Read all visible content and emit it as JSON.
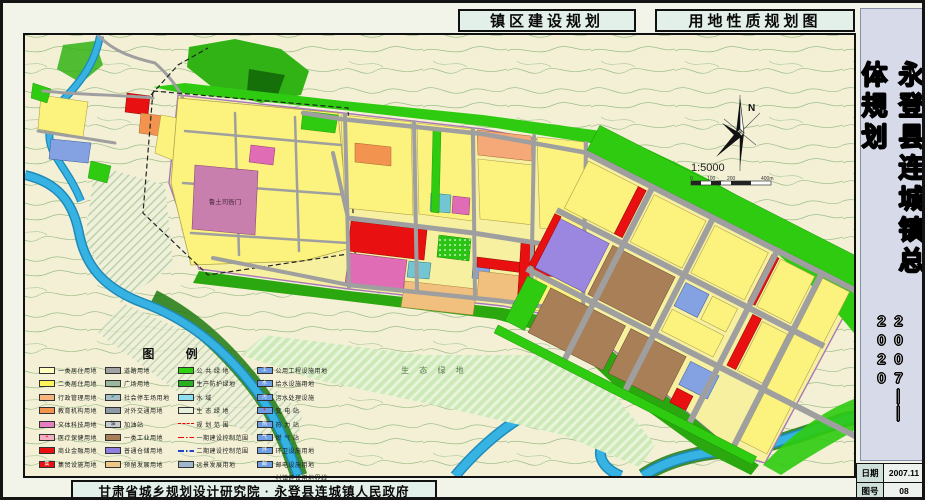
{
  "titles": {
    "left": "镇区建设规划",
    "right": "用地性质规划图"
  },
  "sidebar": {
    "title": "永登县连城镇总体规划",
    "years_top": "2007",
    "years_sep": "——",
    "years_bottom": "2020"
  },
  "info": {
    "rows": [
      {
        "label": "日期",
        "value": "2007.11"
      },
      {
        "label": "图号",
        "value": "08"
      }
    ]
  },
  "footer": {
    "attribution": "甘肃省城乡规划设计研究院 · 永登县连城镇人民政府"
  },
  "map": {
    "labels": {
      "luTusi": "鲁土司衙门",
      "eco": "生 态 绿 地"
    },
    "north": "N",
    "scale": {
      "text": "1:5000",
      "ticks": [
        "0",
        "100",
        "200",
        "400m"
      ]
    }
  },
  "legend": {
    "title": "图 例",
    "columns": [
      [
        {
          "label": "一类居住用地",
          "type": "fill",
          "color": "#ffffc2"
        },
        {
          "label": "二类居住用地",
          "type": "fill",
          "color": "#fdf35a"
        },
        {
          "label": "行政管理用地",
          "type": "fill",
          "color": "#f8b47e"
        },
        {
          "label": "教育机构用地",
          "type": "fill",
          "color": "#f2944e"
        },
        {
          "label": "文体科技用地",
          "type": "fill",
          "color": "#e67ec2"
        },
        {
          "label": "医疗保健用地",
          "type": "fill",
          "color": "#f4aec4",
          "glyph": "+",
          "glyphColor": "#d00"
        },
        {
          "label": "商业金融用地",
          "type": "fill",
          "color": "#e81010"
        },
        {
          "label": "集贸设施用地",
          "type": "fill",
          "color": "#e81010",
          "glyph": "集",
          "glyphColor": "#fff"
        }
      ],
      [
        {
          "label": "道路用地",
          "type": "fill",
          "color": "#a2a2a2"
        },
        {
          "label": "广场用地",
          "type": "fill",
          "color": "#9cb89c"
        },
        {
          "label": "社会停车场用地",
          "type": "fill",
          "color": "#a8bcc6",
          "glyph": "P",
          "glyphColor": "#066"
        },
        {
          "label": "对外交通用地",
          "type": "fill",
          "color": "#8f9aa6"
        },
        {
          "label": "加油站",
          "type": "fill",
          "color": "#c8ccd0",
          "glyph": "油",
          "glyphColor": "#333"
        },
        {
          "label": "一类工业用地",
          "type": "fill",
          "color": "#a97f58"
        },
        {
          "label": "普通仓储用地",
          "type": "fill",
          "color": "#8f7fe0"
        },
        {
          "label": "预留发展用地",
          "type": "fill",
          "color": "#eec884"
        }
      ],
      [
        {
          "label": "公 共 绿 地",
          "type": "fill",
          "color": "#2ed20e"
        },
        {
          "label": "生产防护绿地",
          "type": "fill",
          "color": "#28b020"
        },
        {
          "label": "水   域",
          "type": "fill",
          "color": "#8fdff2"
        },
        {
          "label": "生 态 绿 地",
          "type": "fill",
          "color": "#e8efdc"
        },
        {
          "label": "规 划 范 围",
          "type": "dash-red"
        },
        {
          "label": "一期建设控制范围",
          "type": "dashdot-red"
        },
        {
          "label": "二期建设控制范围",
          "type": "dashdot-blue"
        },
        {
          "label": "远景发展用地",
          "type": "fill",
          "color": "#9fb6cc"
        }
      ],
      [
        {
          "label": "公用工程设施用地",
          "type": "fill",
          "color": "#6f9fe2",
          "glyph": "工",
          "glyphColor": "#fff"
        },
        {
          "label": "给水设施用地",
          "type": "fill",
          "color": "#6f9fe2",
          "glyph": "水",
          "glyphColor": "#fff"
        },
        {
          "label": "污水处理设施",
          "type": "fill",
          "color": "#6f9fe2",
          "glyph": "污",
          "glyphColor": "#fff"
        },
        {
          "label": "变 电 站",
          "type": "fill",
          "color": "#6f9fe2",
          "glyph": "⚡",
          "glyphColor": "#d00"
        },
        {
          "label": "热 力 站",
          "type": "fill",
          "color": "#6f9fe2",
          "glyph": "热",
          "glyphColor": "#fff"
        },
        {
          "label": "燃 气 站",
          "type": "fill",
          "color": "#6f9fe2",
          "glyph": "气",
          "glyphColor": "#fff"
        },
        {
          "label": "环卫设施用地",
          "type": "fill",
          "color": "#6f9fe2",
          "glyph": "环",
          "glyphColor": "#fff"
        },
        {
          "label": "邮电设施用地",
          "type": "fill",
          "color": "#6f9fe2",
          "glyph": "邮",
          "glyphColor": "#fff"
        },
        {
          "label": "村镇建设用地界线",
          "type": "dash-black"
        }
      ]
    ]
  },
  "colors": {
    "cream": "#f4f0d6",
    "contour": "#9cbd88",
    "riverFill": "#36b3e3",
    "riverEdge": "#1f8ab8",
    "bankGreen": "#1d7a10",
    "bandBase": "#f7f0a0",
    "yellow": "#fcf37e",
    "tan": "#f2c07e",
    "orange": "#f29350",
    "salmon": "#f5a878",
    "red": "#e81010",
    "magenta": "#df6cb4",
    "pinkCore": "#c97fae",
    "purple": "#9b87e0",
    "brown": "#a97f58",
    "blue": "#84a2e2",
    "cyan": "#72c5d2",
    "green": "#2ecb10",
    "midGreen": "#2ba70f",
    "hillGreen": "#31b315",
    "darkGreen": "#15700a",
    "ecoBg": "#cde9b8",
    "road": "#9f9f9f",
    "boundary": "#a678b8",
    "panelBg": "#e3efe9",
    "sidebarBg": "#d7dae8"
  }
}
